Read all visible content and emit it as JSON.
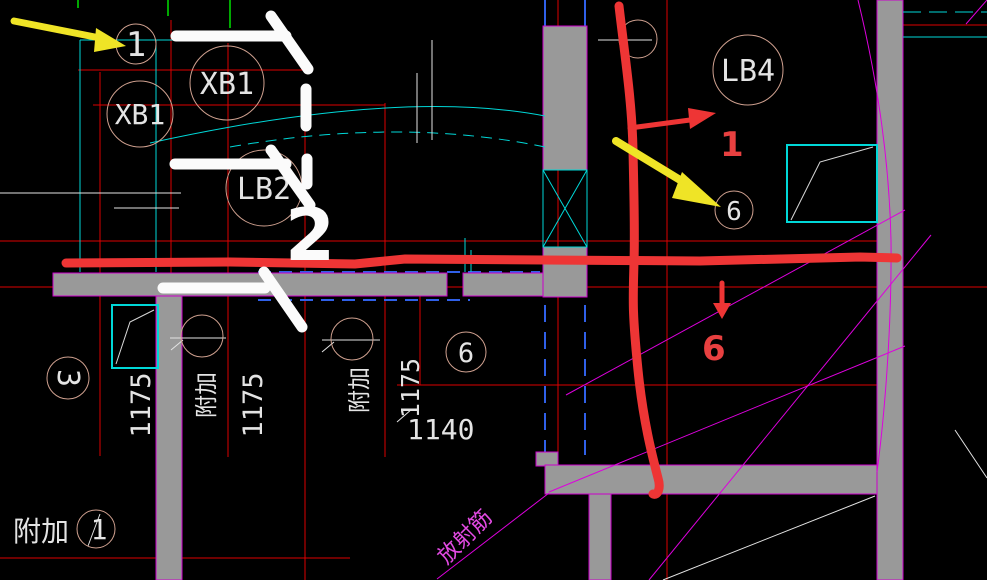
{
  "drawing": {
    "slab_labels": {
      "xb1_left": "XB1",
      "xb1_top": "XB1",
      "lb2": "LB2",
      "lb4": "LB4"
    },
    "bubbles": {
      "axis1_top": "1",
      "n6_upper": "6",
      "n3_left": "3",
      "n6_mid": "6",
      "axis1_bottom": "1"
    },
    "dims": {
      "a": "1175",
      "b": "1175",
      "c": "1175",
      "d": "1140"
    },
    "cn": {
      "fujia_left": "附加",
      "fujia_mid": "附加",
      "fujia_bottom": "附加",
      "fangshejin": "放射筋"
    },
    "marks": {
      "red_1": "1",
      "red_6": "6",
      "white_2": "2"
    }
  },
  "colors": {
    "background": "#000000",
    "grid_red": "#dd0000",
    "cyan": "#00d8d8",
    "blue_dash": "#3060e8",
    "magenta": "#dd00dd",
    "green_tick": "#00a800",
    "wall_gray": "#999999",
    "bubble_stroke": "#cfa08f",
    "cad_text": "#e4e4e4",
    "marker_red": "#ee3535",
    "marker_yellow": "#efe426",
    "marker_white": "#fbfbfb"
  }
}
